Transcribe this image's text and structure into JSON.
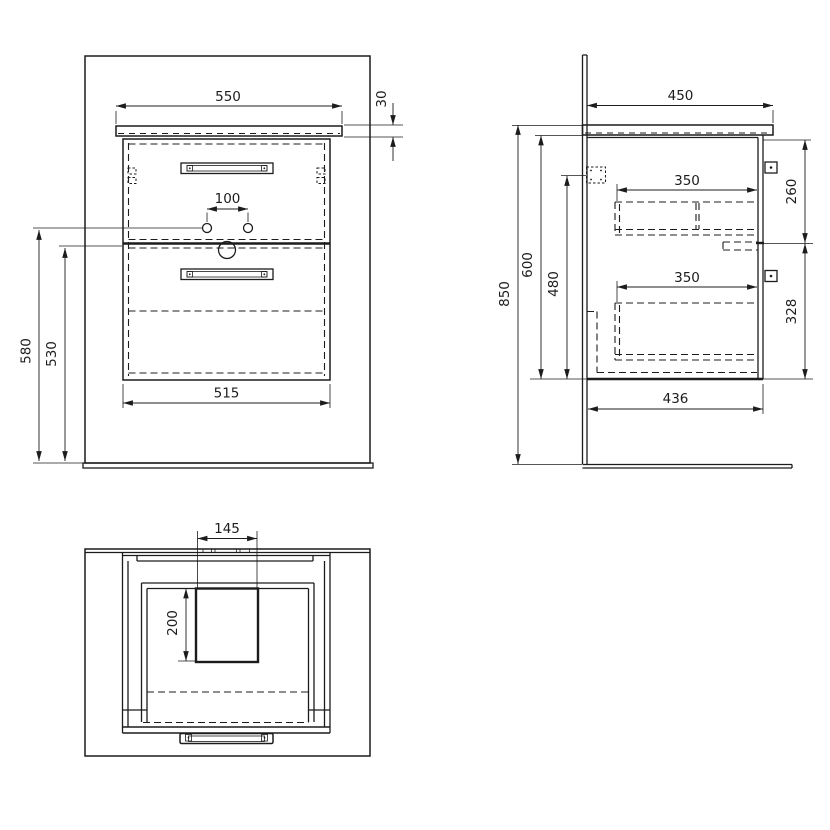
{
  "drawing_title": "vanity cabinet technical drawing",
  "colors": {
    "line": "#1c1c1c",
    "background": "#ffffff"
  },
  "front_view": {
    "dim_countertop_width": "550",
    "dim_countertop_thickness": "30",
    "dim_faucet_hole_spacing": "100",
    "dim_total_height": "580",
    "dim_cabinet_height": "530",
    "dim_cabinet_width": "515"
  },
  "side_view": {
    "dim_countertop_depth": "450",
    "dim_overall_height": "850",
    "dim_front_height": "600",
    "dim_hinge_height": "480",
    "dim_upper_drawer_depth": "350",
    "dim_lower_drawer_depth": "350",
    "dim_upper_drawer_height": "260",
    "dim_lower_drawer_height": "328",
    "dim_cabinet_depth": "436"
  },
  "top_view": {
    "dim_sink_cutout_width": "145",
    "dim_sink_cutout_depth": "200"
  }
}
